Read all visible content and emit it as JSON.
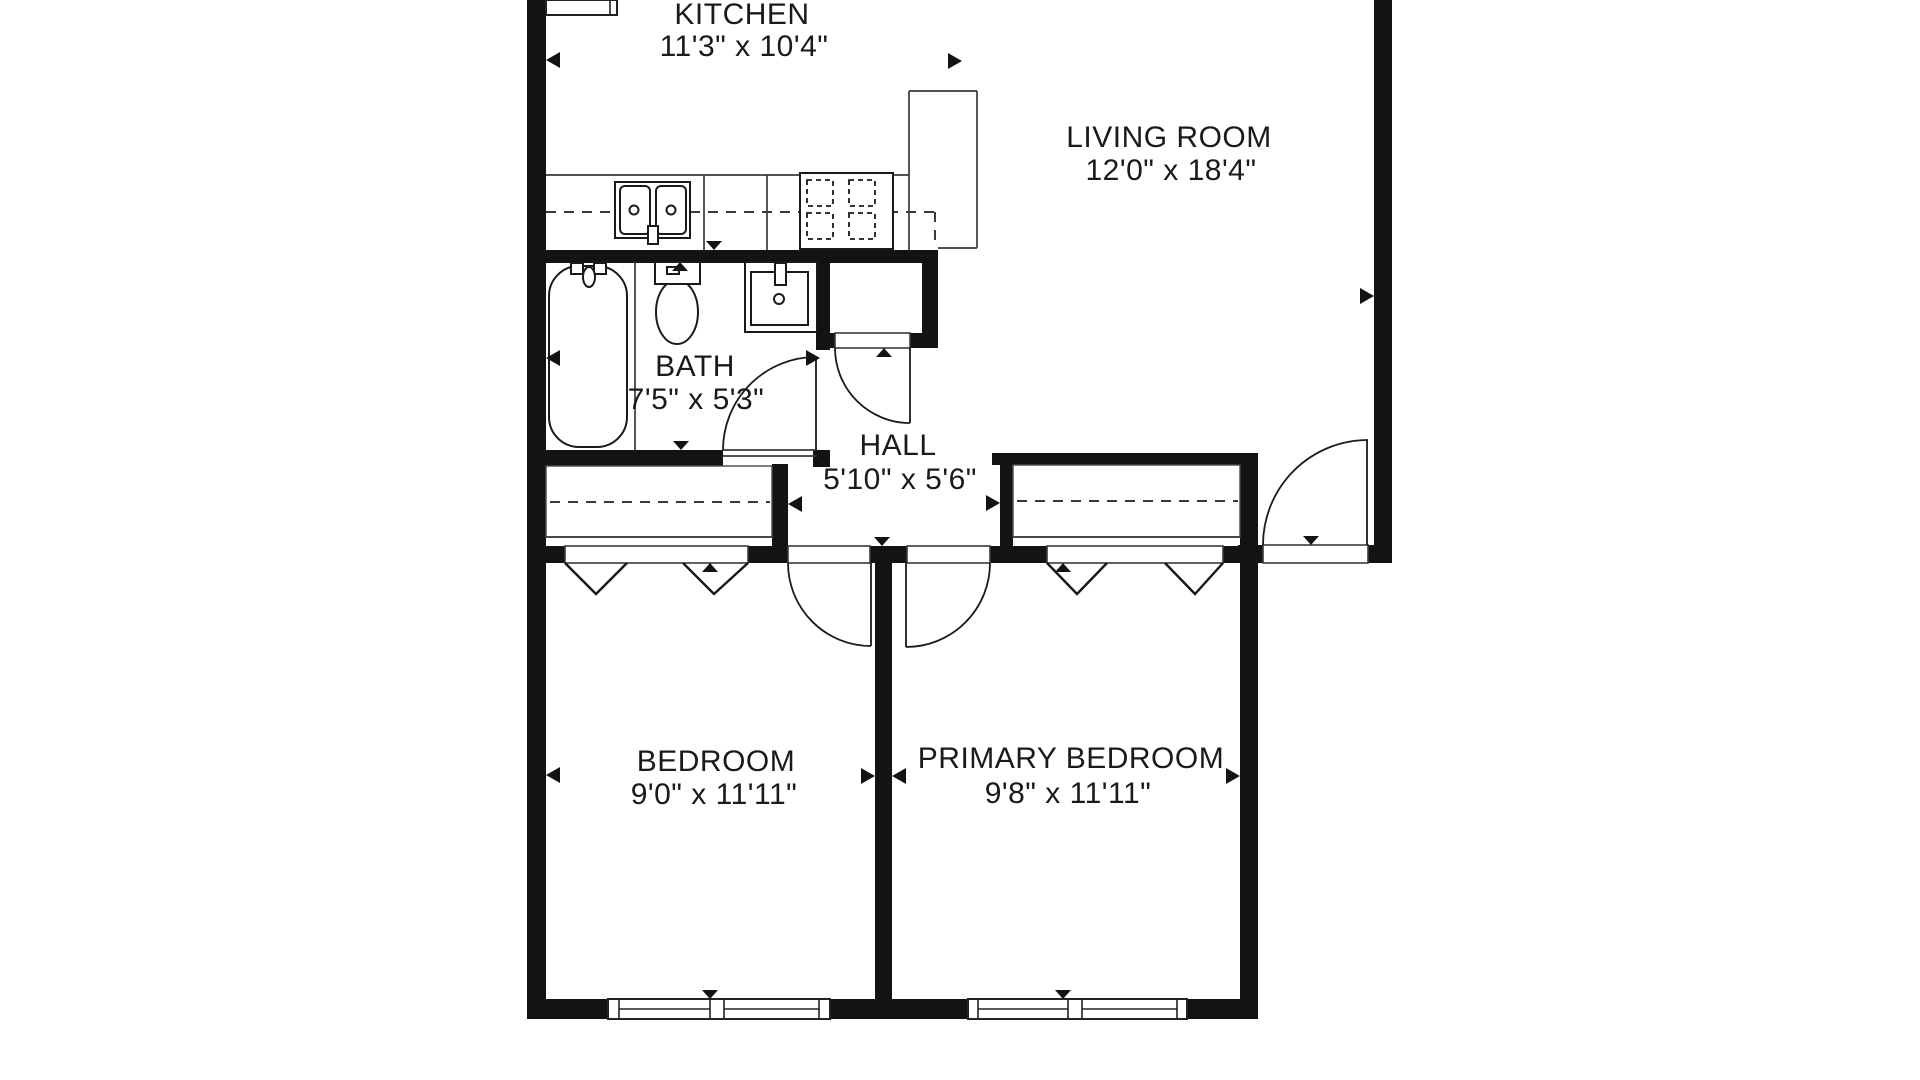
{
  "colors": {
    "wall": "#131313",
    "thin_line": "#3a3a3a",
    "fixture_line": "#1a1a1a",
    "background": "#ffffff"
  },
  "rooms": {
    "kitchen": {
      "name": "KITCHEN",
      "dims": "11'3\" x 10'4\""
    },
    "living": {
      "name": "LIVING ROOM",
      "dims": "12'0\" x 18'4\""
    },
    "bath": {
      "name": "BATH",
      "dims": "7'5\" x 5'3\""
    },
    "hall": {
      "name": "HALL",
      "dims": "5'10\" x 5'6\""
    },
    "bedroom": {
      "name": "BEDROOM",
      "dims": "9'0\" x 11'11\""
    },
    "primary": {
      "name": "PRIMARY BEDROOM",
      "dims": "9'8\" x 11'11\""
    }
  },
  "plan": {
    "walls": [
      {
        "n": "left-outer-wall",
        "r": [
          527,
          0,
          19,
          1019
        ]
      },
      {
        "n": "kitchen-bath-wall",
        "r": [
          527,
          250,
          411,
          13
        ]
      },
      {
        "n": "bath-right-wall",
        "r": [
          816,
          262,
          14,
          88
        ]
      },
      {
        "n": "hall-closet-right-wall",
        "r": [
          922,
          262,
          16,
          86
        ]
      },
      {
        "n": "hall-closet-front-left",
        "r": [
          816,
          333,
          19,
          15
        ]
      },
      {
        "n": "hall-closet-front-right",
        "r": [
          910,
          333,
          28,
          15
        ]
      },
      {
        "n": "bath-bottom-wall",
        "r": [
          527,
          450,
          196,
          16
        ]
      },
      {
        "n": "bath-door-post",
        "r": [
          813,
          450,
          17,
          17
        ]
      },
      {
        "n": "bedroom-closet-right-wall",
        "r": [
          772,
          464,
          16,
          99
        ]
      },
      {
        "n": "bedroom-closet-front-left",
        "r": [
          527,
          546,
          38,
          17
        ]
      },
      {
        "n": "bedroom-closet-front-right",
        "r": [
          748,
          546,
          40,
          17
        ]
      },
      {
        "n": "hall-wall-between-doors",
        "r": [
          870,
          546,
          37,
          17
        ]
      },
      {
        "n": "primary-closet-front-left",
        "r": [
          990,
          546,
          57,
          17
        ]
      },
      {
        "n": "primary-closet-front-right",
        "r": [
          1223,
          546,
          45,
          17
        ]
      },
      {
        "n": "entry-wall-right",
        "r": [
          1368,
          545,
          24,
          18
        ]
      },
      {
        "n": "bedroom-divider-wall",
        "r": [
          875,
          563,
          17,
          436
        ]
      },
      {
        "n": "primary-closet-top-wall",
        "r": [
          992,
          453,
          263,
          12
        ]
      },
      {
        "n": "primary-closet-left-wall",
        "r": [
          1000,
          465,
          13,
          81
        ]
      },
      {
        "n": "primary-right-wall",
        "r": [
          1240,
          453,
          18,
          566
        ]
      },
      {
        "n": "bottom-wall-left",
        "r": [
          527,
          999,
          82,
          20
        ]
      },
      {
        "n": "bottom-wall-middle",
        "r": [
          830,
          999,
          138,
          20
        ]
      },
      {
        "n": "bottom-wall-right",
        "r": [
          1187,
          999,
          71,
          20
        ]
      },
      {
        "n": "right-outer-wall",
        "r": [
          1374,
          0,
          18,
          563
        ]
      },
      {
        "n": "living-bottom-wall",
        "r": [
          1238,
          545,
          25,
          18
        ]
      }
    ],
    "openings": [
      {
        "n": "hall-closet-door-opening",
        "r": [
          835,
          333,
          75,
          15
        ]
      },
      {
        "n": "bedroom-door-opening",
        "r": [
          788,
          546,
          82,
          17
        ]
      },
      {
        "n": "primary-door-opening",
        "r": [
          907,
          546,
          83,
          17
        ]
      },
      {
        "n": "entry-door-opening",
        "r": [
          1263,
          545,
          105,
          18
        ]
      },
      {
        "n": "bedroom-closet-track",
        "r": [
          565,
          546,
          183,
          17
        ]
      },
      {
        "n": "primary-closet-track",
        "r": [
          1047,
          546,
          176,
          17
        ]
      }
    ],
    "boxes": [
      {
        "n": "bedroom-closet-interior",
        "r": [
          546,
          466,
          226,
          71
        ]
      },
      {
        "n": "primary-closet-interior",
        "r": [
          1013,
          465,
          227,
          72
        ]
      }
    ],
    "windows": [
      {
        "n": "bedroom-window",
        "r": [
          608,
          999,
          222,
          20
        ],
        "v": [
          619,
          710,
          724,
          819
        ],
        "m": [
          [
            619,
            710
          ],
          [
            724,
            819
          ]
        ],
        "my": 1009
      },
      {
        "n": "primary-window",
        "r": [
          968,
          999,
          219,
          20
        ],
        "v": [
          978,
          1068,
          1082,
          1177
        ],
        "m": [
          [
            978,
            1068
          ],
          [
            1082,
            1177
          ]
        ],
        "my": 1009
      },
      {
        "n": "kitchen-top-window",
        "r": [
          546,
          0,
          71,
          15
        ],
        "v": [
          610
        ],
        "m": [],
        "my": 0
      }
    ],
    "lines": [
      {
        "n": "counter-front-edge",
        "p": [
          546,
          175,
          909,
          175
        ]
      },
      {
        "n": "counter-section-line-1",
        "p": [
          704,
          175,
          704,
          250
        ]
      },
      {
        "n": "counter-section-line-2",
        "p": [
          767,
          175,
          767,
          250
        ]
      },
      {
        "n": "peninsula-left-edge",
        "p": [
          909,
          91,
          909,
          250
        ]
      },
      {
        "n": "peninsula-top-edge",
        "p": [
          909,
          91,
          977,
          91
        ]
      },
      {
        "n": "peninsula-right-edge",
        "p": [
          977,
          91,
          977,
          248
        ]
      },
      {
        "n": "peninsula-bottom-edge",
        "p": [
          938,
          248,
          977,
          248
        ]
      },
      {
        "n": "bath-divider-line",
        "p": [
          635,
          262,
          635,
          450
        ]
      },
      {
        "n": "bedroom-closet-front-line",
        "p": [
          546,
          537,
          772,
          537
        ]
      },
      {
        "n": "primary-closet-front-line",
        "p": [
          1013,
          537,
          1240,
          537
        ]
      },
      {
        "n": "bath-door-sill-top",
        "p": [
          723,
          450,
          817,
          450
        ]
      },
      {
        "n": "bath-door-sill-bottom",
        "p": [
          723,
          456,
          817,
          456
        ]
      }
    ],
    "dashes": [
      {
        "n": "counter-dash-horizontal",
        "p": [
          546,
          212,
          935,
          212
        ]
      },
      {
        "n": "counter-dash-vertical",
        "p": [
          935,
          212,
          935,
          248
        ]
      },
      {
        "n": "bedroom-closet-rod",
        "p": [
          550,
          502,
          770,
          502
        ]
      },
      {
        "n": "primary-closet-rod",
        "p": [
          1017,
          501,
          1238,
          501
        ]
      }
    ],
    "fixtures": [
      {
        "t": "rect",
        "n": "kitchen-sink-unit",
        "a": [
          615,
          182,
          75,
          56
        ]
      },
      {
        "t": "rect",
        "n": "kitchen-sink-basin-left",
        "a": [
          620,
          186,
          30,
          48
        ],
        "rx": 5
      },
      {
        "t": "rect",
        "n": "kitchen-sink-basin-right",
        "a": [
          656,
          186,
          30,
          48
        ],
        "rx": 5
      },
      {
        "t": "circle",
        "n": "kitchen-sink-drain-left",
        "a": [
          634,
          210,
          4.5
        ]
      },
      {
        "t": "circle",
        "n": "kitchen-sink-drain-right",
        "a": [
          671,
          210,
          4.5
        ]
      },
      {
        "t": "rect",
        "n": "kitchen-faucet",
        "a": [
          648,
          226,
          10,
          18
        ]
      },
      {
        "t": "rect",
        "n": "stove",
        "a": [
          800,
          173,
          93,
          76
        ]
      },
      {
        "t": "rect",
        "n": "stove-burner-1",
        "a": [
          807,
          180,
          26,
          26
        ],
        "c": "burner"
      },
      {
        "t": "rect",
        "n": "stove-burner-2",
        "a": [
          849,
          180,
          26,
          26
        ],
        "c": "burner"
      },
      {
        "t": "rect",
        "n": "stove-burner-3",
        "a": [
          807,
          213,
          26,
          26
        ],
        "c": "burner"
      },
      {
        "t": "rect",
        "n": "stove-burner-4",
        "a": [
          849,
          213,
          26,
          26
        ],
        "c": "burner"
      },
      {
        "t": "rect",
        "n": "bathtub",
        "a": [
          549,
          266,
          78,
          181
        ],
        "rx": 30
      },
      {
        "t": "rect",
        "n": "tub-handle-left",
        "a": [
          571,
          263,
          12,
          11
        ]
      },
      {
        "t": "rect",
        "n": "tub-handle-right",
        "a": [
          594,
          263,
          12,
          11
        ]
      },
      {
        "t": "ellipse",
        "n": "tub-spout",
        "a": [
          589,
          277,
          6,
          10
        ]
      },
      {
        "t": "ellipse",
        "n": "toilet-bowl",
        "a": [
          677,
          312,
          21,
          32
        ]
      },
      {
        "t": "rect",
        "n": "toilet-tank",
        "a": [
          655,
          262,
          45,
          22
        ]
      },
      {
        "t": "rect",
        "n": "toilet-flush-button",
        "a": [
          667,
          267,
          12,
          7
        ]
      },
      {
        "t": "rect",
        "n": "bath-sink",
        "a": [
          745,
          262,
          72,
          70
        ]
      },
      {
        "t": "rect",
        "n": "bath-sink-basin",
        "a": [
          751,
          272,
          57,
          53
        ]
      },
      {
        "t": "rect",
        "n": "bath-faucet",
        "a": [
          775,
          263,
          11,
          22
        ]
      },
      {
        "t": "circle",
        "n": "bath-sink-drain",
        "a": [
          779,
          299,
          5
        ]
      }
    ],
    "leaves": [
      {
        "n": "bath-door-leaf",
        "p": [
          816,
          357,
          816,
          450
        ]
      },
      {
        "n": "hall-closet-door-leaf",
        "p": [
          910,
          348,
          910,
          423
        ]
      },
      {
        "n": "bedroom-door-leaf",
        "p": [
          871,
          563,
          871,
          646
        ]
      },
      {
        "n": "primary-door-leaf",
        "p": [
          906,
          563,
          906,
          647
        ]
      },
      {
        "n": "entry-door-leaf",
        "p": [
          1367,
          440,
          1367,
          545
        ]
      }
    ],
    "arcs": [
      {
        "n": "bath-door-arc",
        "d": "M723 450 A93 93 0 0 1 816 357"
      },
      {
        "n": "hall-closet-door-arc",
        "d": "M835 348 A75 75 0 0 0 910 423"
      },
      {
        "n": "bedroom-door-arc",
        "d": "M788 563 A83 83 0 0 0 871 646"
      },
      {
        "n": "primary-door-arc",
        "d": "M906 647 A84 84 0 0 0 990 563"
      },
      {
        "n": "entry-door-arc",
        "d": "M1263 545 A105 105 0 0 1 1368 440"
      }
    ],
    "zigzags": [
      {
        "n": "bedroom-bifold-left",
        "d": "M565 563 L596 594 L627 563"
      },
      {
        "n": "bedroom-bifold-right",
        "d": "M683 563 L714 594 L748 563"
      },
      {
        "n": "primary-bifold-left",
        "d": "M1047 563 L1077 594 L1107 563"
      },
      {
        "n": "primary-bifold-right",
        "d": "M1165 563 L1195 594 L1223 563"
      }
    ],
    "markers": [
      {
        "n": "marker-kitchen-left",
        "x": 546,
        "y": 60,
        "dir": "left"
      },
      {
        "n": "marker-kitchen-right",
        "x": 962,
        "y": 61,
        "dir": "right"
      },
      {
        "n": "marker-kitchen-bottom",
        "x": 714,
        "y": 250,
        "dir": "down"
      },
      {
        "n": "marker-bath-top",
        "x": 680,
        "y": 262,
        "dir": "up"
      },
      {
        "n": "marker-bath-left",
        "x": 546,
        "y": 358,
        "dir": "left"
      },
      {
        "n": "marker-bath-bottom",
        "x": 681,
        "y": 450,
        "dir": "down"
      },
      {
        "n": "marker-bath-right",
        "x": 820,
        "y": 358,
        "dir": "right"
      },
      {
        "n": "marker-hall-top",
        "x": 884,
        "y": 348,
        "dir": "up"
      },
      {
        "n": "marker-hall-left",
        "x": 788,
        "y": 504,
        "dir": "left"
      },
      {
        "n": "marker-hall-right",
        "x": 1000,
        "y": 503,
        "dir": "right"
      },
      {
        "n": "marker-hall-bottom",
        "x": 882,
        "y": 546,
        "dir": "down"
      },
      {
        "n": "marker-entry-sill",
        "x": 1311,
        "y": 545,
        "dir": "down"
      },
      {
        "n": "marker-living-right",
        "x": 1374,
        "y": 296,
        "dir": "right"
      },
      {
        "n": "marker-bedroom-left",
        "x": 546,
        "y": 775,
        "dir": "left"
      },
      {
        "n": "marker-bedroom-right",
        "x": 875,
        "y": 776,
        "dir": "right"
      },
      {
        "n": "marker-primary-left",
        "x": 892,
        "y": 776,
        "dir": "left"
      },
      {
        "n": "marker-primary-right",
        "x": 1240,
        "y": 776,
        "dir": "right"
      },
      {
        "n": "marker-bedroom-top",
        "x": 710,
        "y": 563,
        "dir": "up"
      },
      {
        "n": "marker-primary-top",
        "x": 1063,
        "y": 563,
        "dir": "up"
      },
      {
        "n": "marker-bedroom-bottom",
        "x": 710,
        "y": 999,
        "dir": "down"
      },
      {
        "n": "marker-primary-bottom",
        "x": 1063,
        "y": 999,
        "dir": "down"
      }
    ]
  }
}
